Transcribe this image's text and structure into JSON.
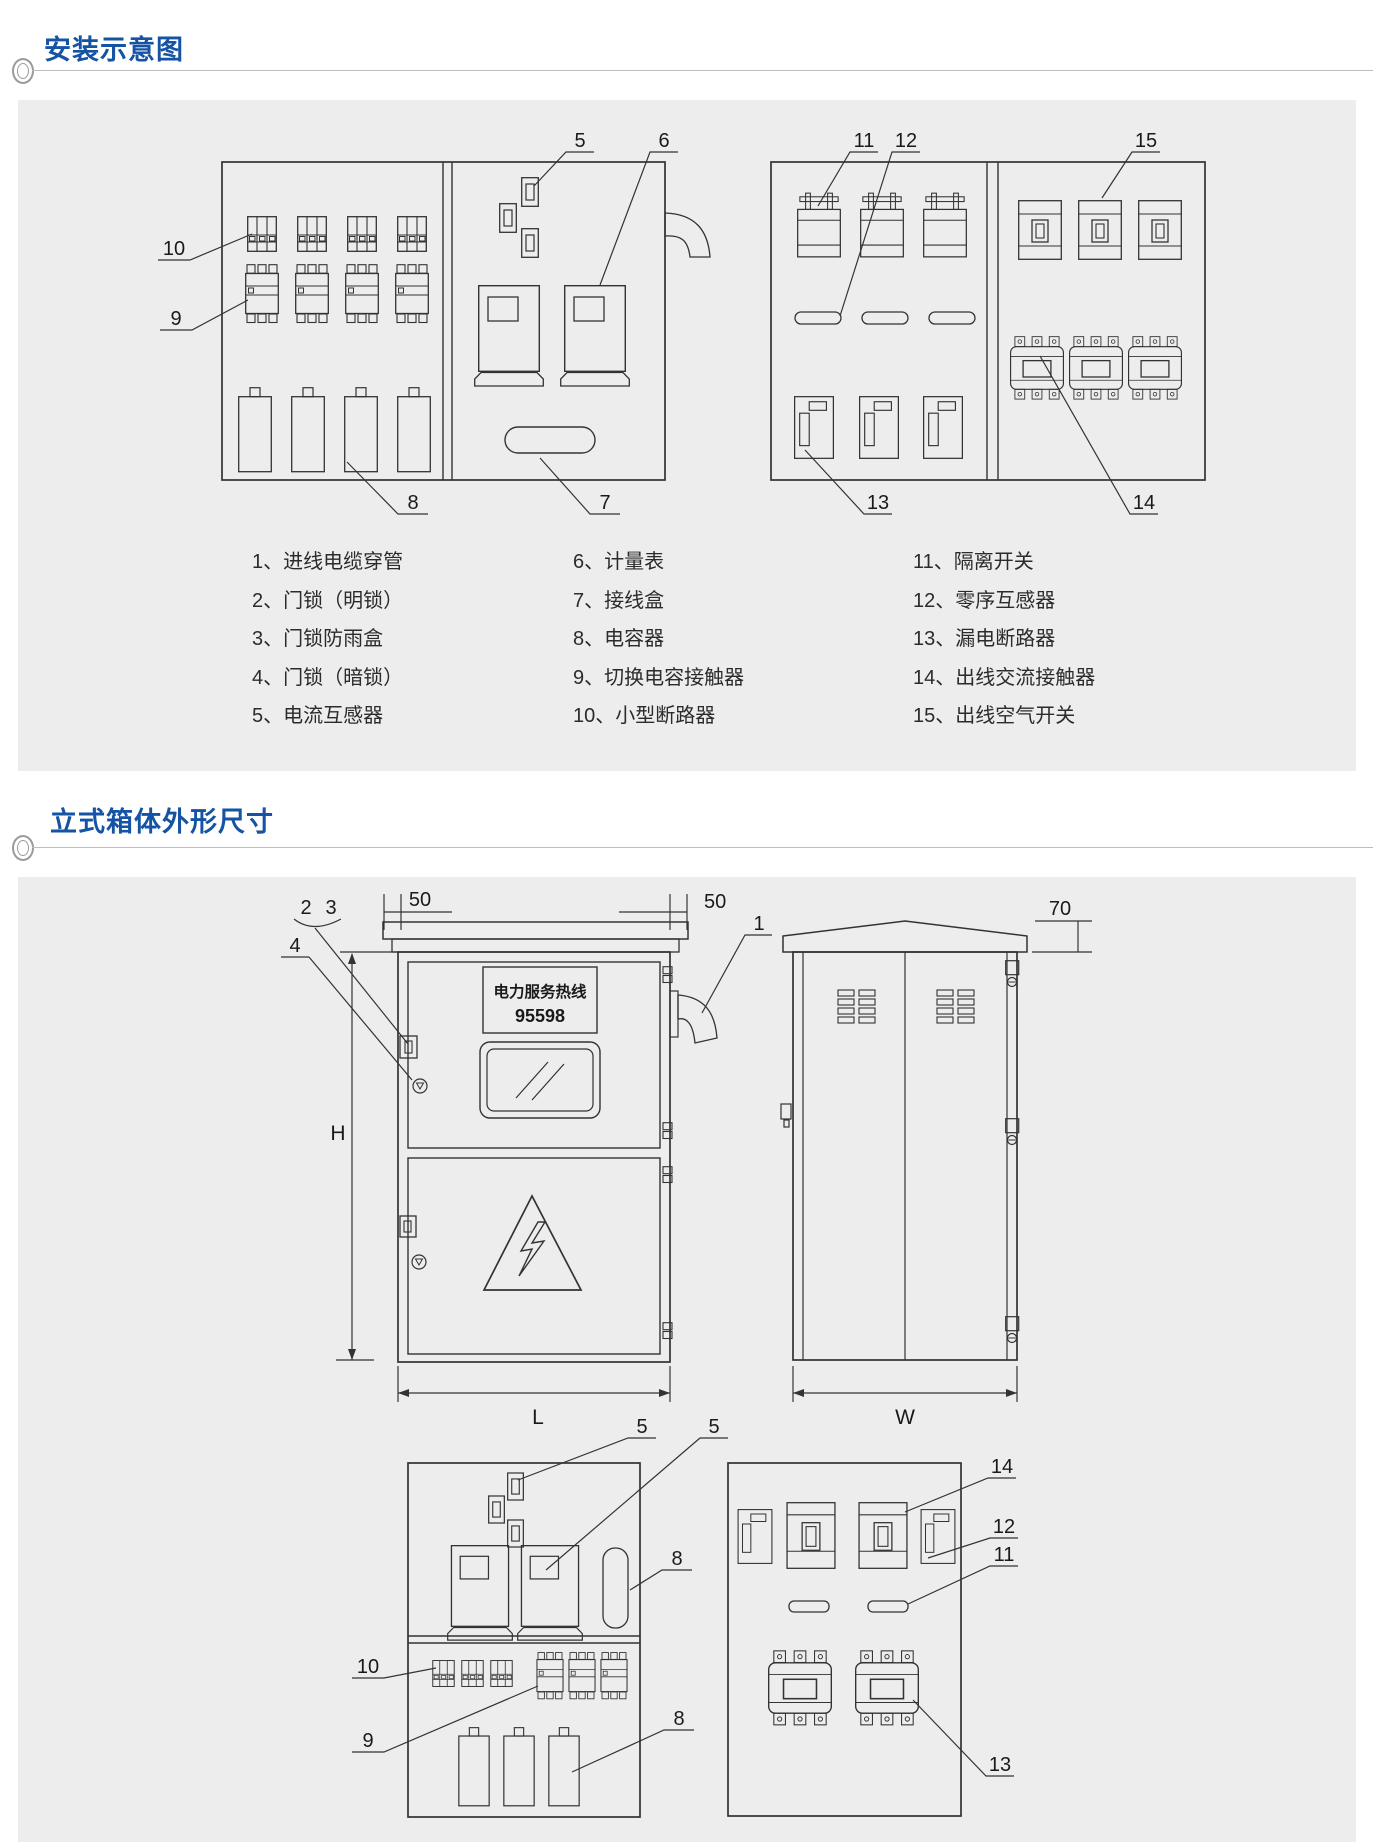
{
  "colors": {
    "accent_blue": "#1553a4",
    "panel_gray": "#ededed",
    "line": "#333333"
  },
  "sections": [
    {
      "title": "安装示意图"
    },
    {
      "title": "立式箱体外形尺寸"
    }
  ],
  "legend": {
    "columns": [
      [
        "1、进线电缆穿管",
        "2、门锁（明锁）",
        "3、门锁防雨盒",
        "4、门锁（暗锁）",
        "5、电流互感器"
      ],
      [
        "6、计量表",
        "7、接线盒",
        "8、电容器",
        "9、切换电容接触器",
        "10、小型断路器"
      ],
      [
        "11、隔离开关",
        "12、零序互感器",
        "13、漏电断路器",
        "14、出线交流接触器",
        "15、出线空气开关"
      ]
    ]
  },
  "callouts": {
    "install_left": {
      "ct": "5",
      "meter": "6",
      "mcb": "10",
      "contactor": "9",
      "capacitor": "8",
      "junction_box": "7"
    },
    "install_right": {
      "isolator": "11",
      "zero_ct": "12",
      "air_switch": "15",
      "leakage": "13",
      "ac_contactor": "14"
    },
    "front": {
      "conduit": "1",
      "lock_open": "2",
      "rain_box": "3",
      "lock_hidden": "4",
      "dim_left": "50",
      "dim_right": "50",
      "height": "H",
      "length": "L"
    },
    "side": {
      "overhang": "70",
      "width": "W"
    },
    "bottom_left": {
      "ct_a": "5",
      "ct_b": "5",
      "junction": "8",
      "mcb": "10",
      "contactor": "9",
      "capacitor": "8"
    },
    "bottom_right": {
      "breaker": "14",
      "zero_ct": "12",
      "isolator": "11",
      "contactor": "13"
    }
  },
  "front_sign": {
    "line1": "电力服务热线",
    "line2": "95598"
  }
}
